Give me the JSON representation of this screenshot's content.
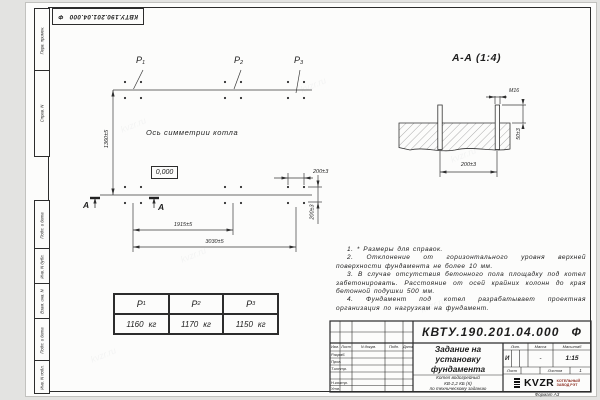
{
  "watermark": "kvzr.ru",
  "top_stamp": {
    "number": "КВТУ.190.201.04.000",
    "suffix": "Ф"
  },
  "frame": {
    "left_top": [
      "Перв. примен.",
      "Справ. N"
    ],
    "left_bottom": [
      "Подп. и дата",
      "Инв. N дубл.",
      "Взам. инв. N",
      "Подп. и дата",
      "Инв. N подл."
    ]
  },
  "plan": {
    "points": [
      {
        "sym": "P",
        "sub": "1"
      },
      {
        "sym": "P",
        "sub": "2"
      },
      {
        "sym": "P",
        "sub": "3"
      }
    ],
    "axis_label": "Ось симметрии котла",
    "elevation": "0,000",
    "section_letter": "А",
    "dims": {
      "height": "1360±5",
      "mid_span": "1915±5",
      "total_span": "3030±5",
      "bolt_spacing_x": "200±3",
      "bolt_spacing_y": "200±3"
    }
  },
  "section_view": {
    "title": "А-А (1:4)",
    "thread_label": "М16",
    "dims": {
      "protrusion": "50±3",
      "bolt_spacing": "200±3"
    }
  },
  "notes": [
    "1. * Размеры для справок.",
    "2. Отклонение от горизонтального уровня верхней поверхности фундамента не более 10 мм.",
    "3. В случае отсутствия бетонного пола площадку под котел забетонировать. Расстояние от осей крайних колонн до края бетонной подушки 500 мм.",
    "4. Фундамент под котел разрабатывает проектная организация по нагрузкам на фундамент."
  ],
  "load_table": {
    "headers": [
      {
        "sym": "P",
        "sub": "1"
      },
      {
        "sym": "P",
        "sub": "2"
      },
      {
        "sym": "P",
        "sub": "3"
      }
    ],
    "values": [
      {
        "value": "1160",
        "unit": "кг"
      },
      {
        "value": "1170",
        "unit": "кг"
      },
      {
        "value": "1150",
        "unit": "кг"
      }
    ]
  },
  "title_block": {
    "doc_number": "КВТУ.190.201.04.000",
    "doc_suffix": "Ф",
    "title": "Задание на\nустановку\nфундамента",
    "product": "Котел водогрейный\nКВ-2,2 КБ (К)\nпо техническому заданию",
    "col_headers": {
      "izm": "Изм.",
      "sheet": "Лист",
      "doc": "N докум.",
      "sign": "Подп.",
      "date": "Дата"
    },
    "row_labels": [
      "Разраб.",
      "Пров.",
      "Т.контр.",
      "Н.контр.",
      "Утв."
    ],
    "lit_label": "Лит.",
    "mass_label": "Масса",
    "scale_label": "Масштаб",
    "lit_value": "И",
    "mass_value": "-",
    "scale_value": "1:15",
    "sheet_label": "Лист",
    "sheets_label": "Листов",
    "sheets_value": "1",
    "logo_text": "KVZR",
    "logo_caption": "КОТЕЛЬНЫЙ\nЗАВОД РЭТ",
    "format_label": "Формат А3"
  }
}
